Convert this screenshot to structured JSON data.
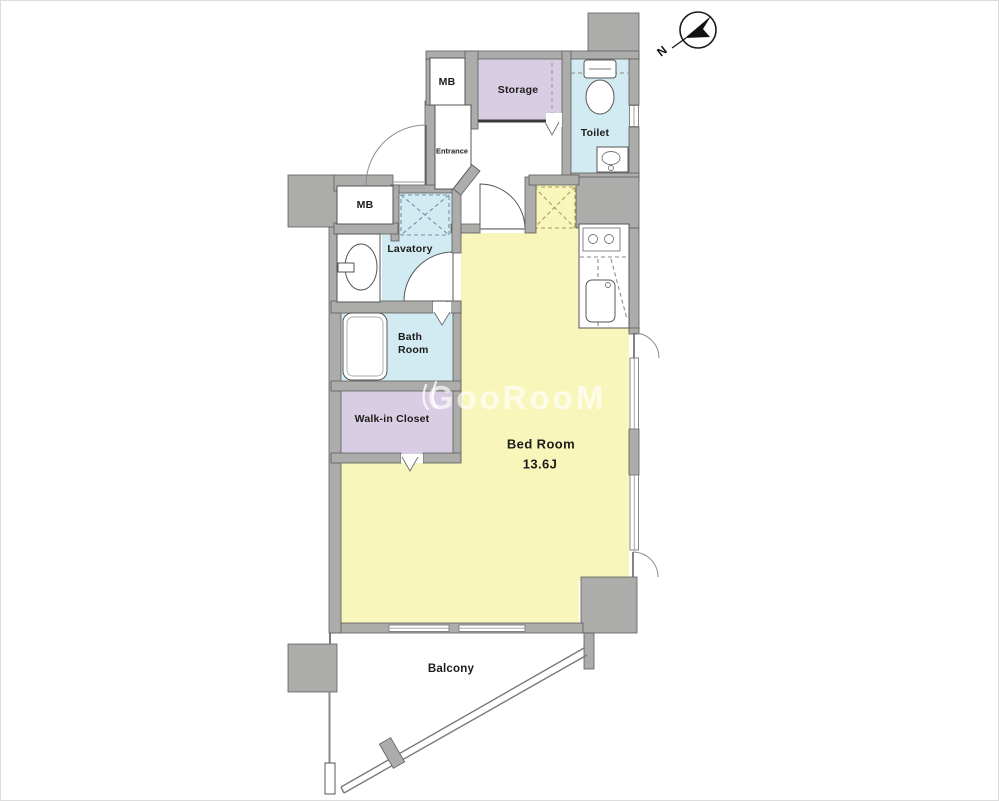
{
  "labels": {
    "mb_top": "MB",
    "mb_left": "MB",
    "storage": "Storage",
    "toilet": "Toilet",
    "entrance": "Entrance",
    "lavatory": "Lavatory",
    "bath_line1": "Bath",
    "bath_line2": "Room",
    "walk_in_closet": "Walk-in Closet",
    "bed_room": "Bed Room",
    "bed_room_size": "13.6J",
    "balcony": "Balcony",
    "compass_north": "N"
  },
  "watermark": {
    "text": "GooRooM"
  },
  "colors": {
    "room_yellow": "#F9F6BB",
    "room_purple": "#D9CDE3",
    "room_blue": "#D2EAF1",
    "pad_blue": "#C9E6EE",
    "wall": "#ACACAB",
    "dash_blue": "#6D95A5",
    "dash_olive": "#A89F56"
  }
}
